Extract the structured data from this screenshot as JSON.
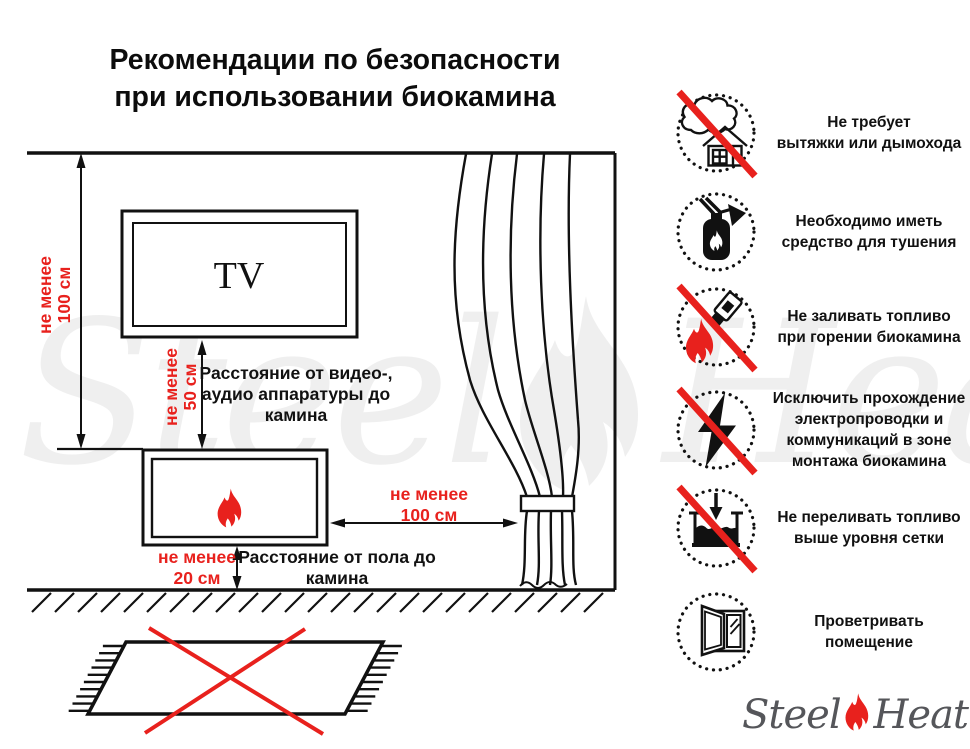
{
  "title": {
    "line1": "Рекомендации по безопасности",
    "line2": "при использовании биокамина"
  },
  "colors": {
    "accent_red": "#e8211d",
    "line_black": "#111111",
    "logo_gray": "#55565a"
  },
  "diagram": {
    "tv_label": "TV",
    "dim_wall": {
      "line1": "не менее",
      "line2": "100 см"
    },
    "dim_tv": {
      "line1": "не менее",
      "line2": "50 см"
    },
    "dim_curtain": {
      "line1": "не менее",
      "line2": "100 см"
    },
    "dim_floor": {
      "line1": "не менее",
      "line2": "20 см"
    },
    "label_tv": {
      "line1": "Расстояние от видео-,",
      "line2": "аудио аппаратуры до",
      "line3": "камина"
    },
    "label_floor": {
      "line1": "Расстояние от пола до",
      "line2": "камина"
    }
  },
  "rules": [
    {
      "icon": "no-chimney-icon",
      "crossed": true,
      "lines": [
        "Не требует",
        "вытяжки или дымохода"
      ]
    },
    {
      "icon": "extinguisher-icon",
      "crossed": false,
      "lines": [
        "Необходимо иметь",
        "средство для тушения"
      ]
    },
    {
      "icon": "no-refuel-while-burning-icon",
      "crossed": true,
      "lines": [
        "Не заливать топливо",
        "при горении биокамина"
      ]
    },
    {
      "icon": "no-wiring-icon",
      "crossed": true,
      "lines": [
        "Исключить прохождение",
        "электропроводки и",
        "коммуникаций в зоне",
        "монтажа биокамина"
      ]
    },
    {
      "icon": "no-overfill-icon",
      "crossed": true,
      "lines": [
        "Не переливать топливо",
        "выше уровня сетки"
      ]
    },
    {
      "icon": "ventilate-icon",
      "crossed": false,
      "lines": [
        "Проветривать",
        "помещение"
      ]
    }
  ],
  "watermark": {
    "steel": "Steel",
    "heat": "Heat"
  },
  "logo": {
    "steel": "Steel",
    "heat": "Heat"
  }
}
